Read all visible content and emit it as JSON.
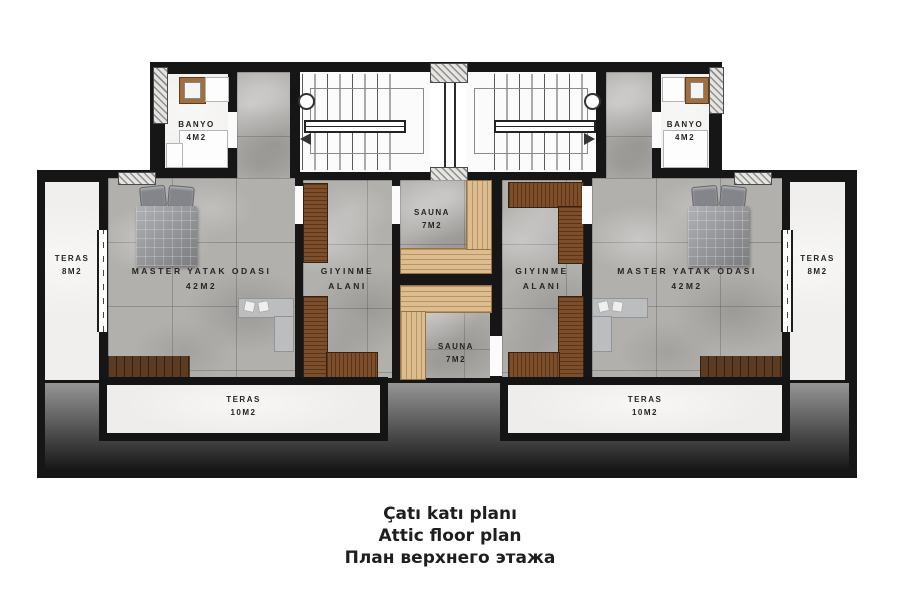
{
  "caption": {
    "line1": "Çatı katı planı",
    "line2": "Attic floor plan",
    "line3": "План верхнего этажа"
  },
  "rooms": {
    "banyo_left": {
      "name": "BANYO",
      "area": "4M2"
    },
    "banyo_right": {
      "name": "BANYO",
      "area": "4M2"
    },
    "teras_left": {
      "name": "TERAS",
      "area": "8M2"
    },
    "teras_right": {
      "name": "TERAS",
      "area": "8M2"
    },
    "master_left": {
      "name": "MASTER YATAK ODASI",
      "area": "42M2"
    },
    "master_right": {
      "name": "MASTER YATAK ODASI",
      "area": "42M2"
    },
    "giyinme_left": {
      "name": "GIYINME",
      "area": "ALANI"
    },
    "giyinme_right": {
      "name": "GIYINME",
      "area": "ALANI"
    },
    "sauna_top": {
      "name": "SAUNA",
      "area": "7M2"
    },
    "sauna_bottom": {
      "name": "SAUNA",
      "area": "7M2"
    },
    "teras10_left": {
      "name": "TERAS",
      "area": "10M2"
    },
    "teras10_right": {
      "name": "TERAS",
      "area": "10M2"
    }
  },
  "colors": {
    "wall": "#161616",
    "marble_floor": "#b2b0ad",
    "terrace_floor": "#efedeb",
    "sauna_bench": "#dcbd8f",
    "wardrobe_wood": "#7d4e2a",
    "roof_gradient_top": "#959595",
    "roof_gradient_bottom": "#161616"
  }
}
